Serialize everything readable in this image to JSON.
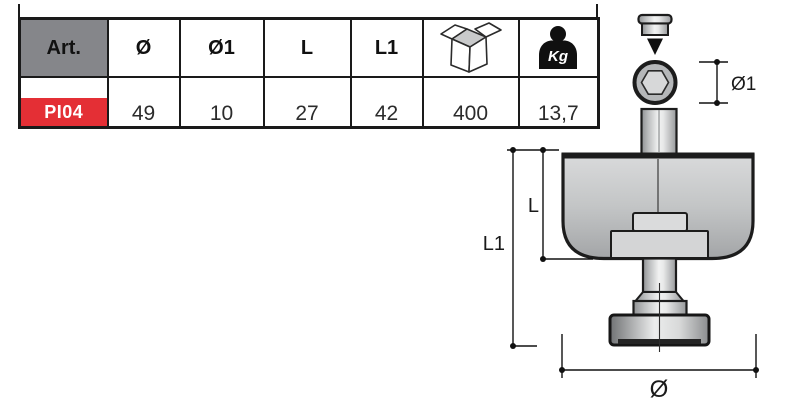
{
  "table": {
    "headers": [
      {
        "label": "Art."
      },
      {
        "label": "Ø"
      },
      {
        "label": "Ø1"
      },
      {
        "label": "L"
      },
      {
        "label": "L1"
      },
      {
        "icon": "box-icon"
      },
      {
        "icon": "weight-icon",
        "label": "Kg"
      }
    ],
    "row": {
      "art": "PI04",
      "d": "49",
      "d1": "10",
      "l": "27",
      "l1": "42",
      "pack": "400",
      "kg": "13,7"
    }
  },
  "diagram": {
    "labels": {
      "d1": "Ø1",
      "l": "L",
      "l1": "L1",
      "d": "Ø"
    }
  },
  "colors": {
    "accent_red": "#e42f35",
    "header_gray": "#85868a",
    "line_black": "#1a1a1a"
  }
}
